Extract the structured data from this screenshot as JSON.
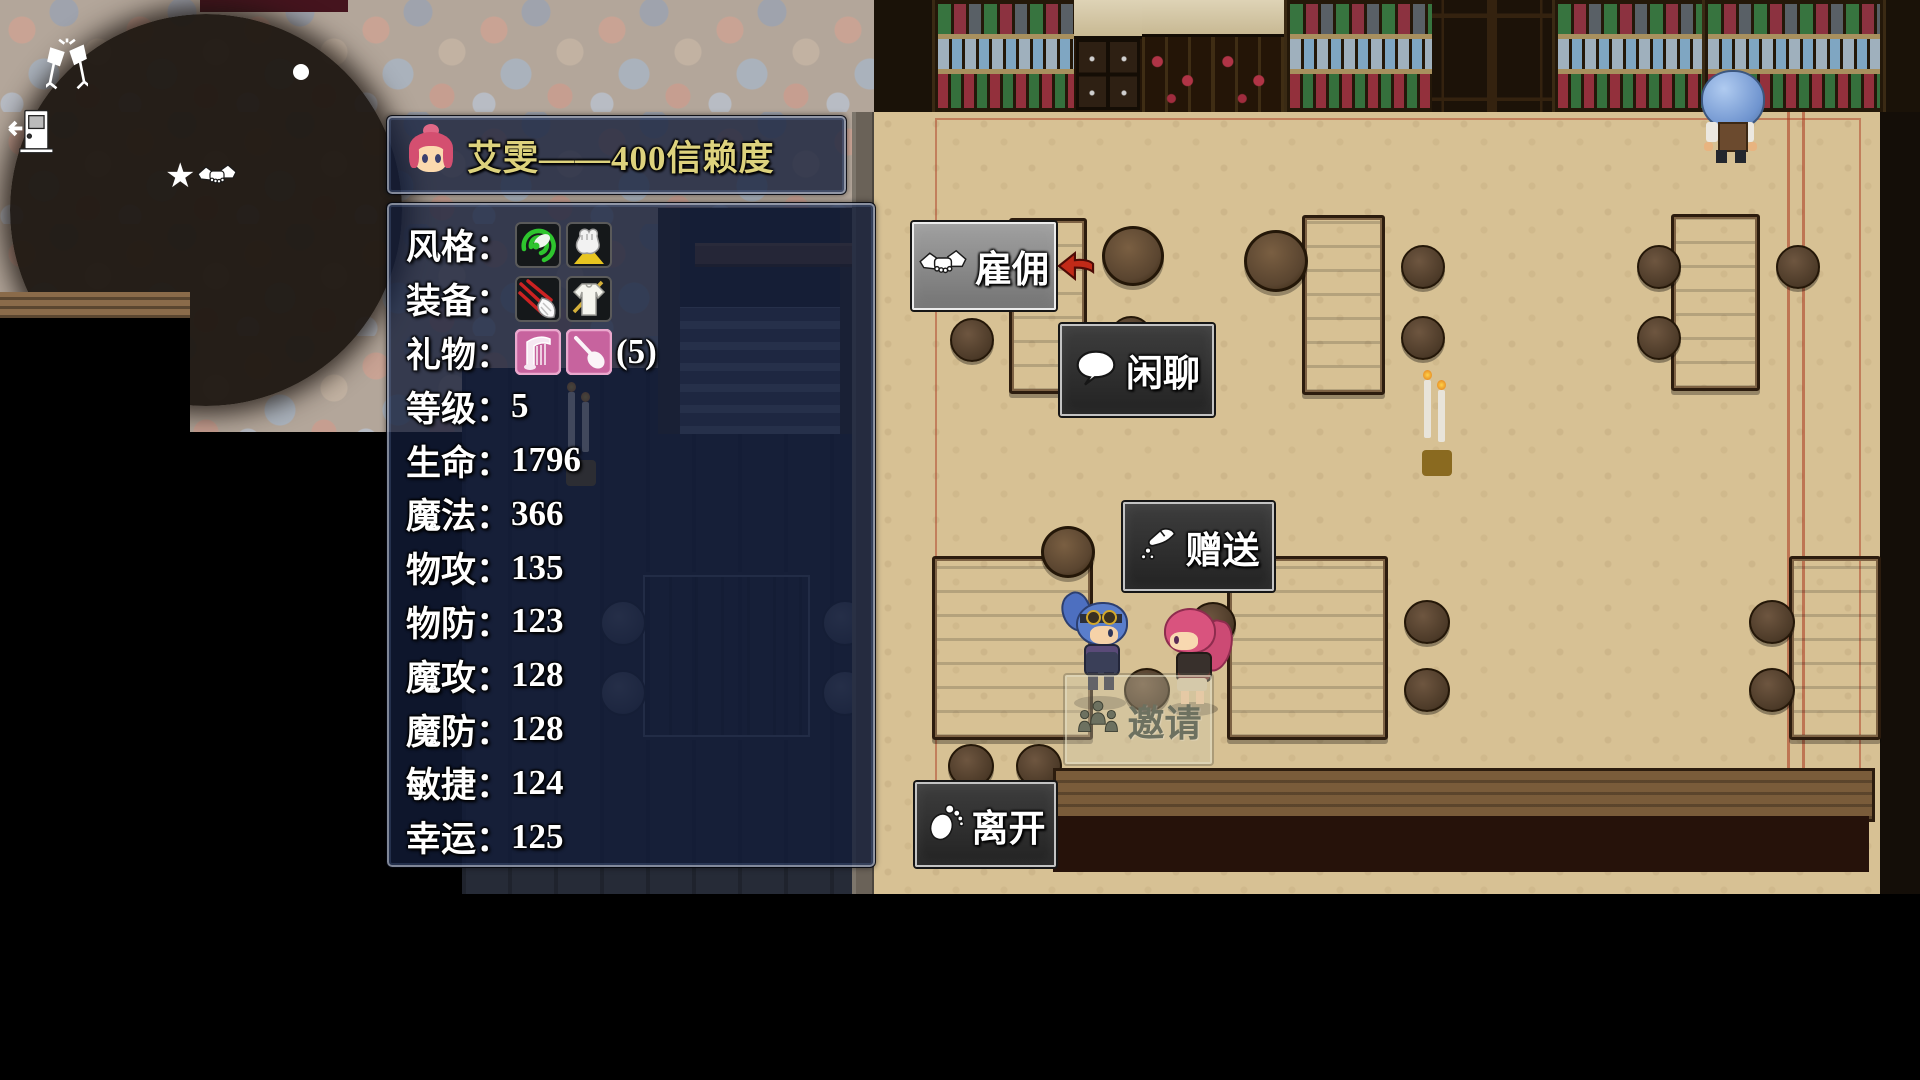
{
  "panel": {
    "title": "艾雯——400信赖度",
    "rows": [
      {
        "label": "风格：",
        "icons": [
          "style-green-whirl-icon",
          "style-yellow-fist-icon"
        ]
      },
      {
        "label": "装备：",
        "icons": [
          "equip-claw-icon",
          "equip-armor-icon"
        ]
      },
      {
        "label": "礼物：",
        "icons": [
          "gift-harp-icon",
          "gift-spoon-icon"
        ],
        "suffix": "(5)"
      },
      {
        "label": "等级：",
        "value": "5"
      },
      {
        "label": "生命：",
        "value": "1796"
      },
      {
        "label": "魔法：",
        "value": "366"
      },
      {
        "label": "物攻：",
        "value": "135"
      },
      {
        "label": "物防：",
        "value": "123"
      },
      {
        "label": "魔攻：",
        "value": "128"
      },
      {
        "label": "魔防：",
        "value": "128"
      },
      {
        "label": "敏捷：",
        "value": "124"
      },
      {
        "label": "幸运：",
        "value": "125"
      }
    ]
  },
  "action_menu": {
    "buttons": [
      {
        "label": "雇佣",
        "icon": "handshake-icon",
        "state": "selected"
      },
      {
        "label": "闲聊",
        "icon": "speech-bubble-icon",
        "state": "normal"
      },
      {
        "label": "赠送",
        "icon": "give-hand-icon",
        "state": "normal"
      },
      {
        "label": "邀请",
        "icon": "group-people-icon",
        "state": "disabled"
      },
      {
        "label": "离开",
        "icon": "footprint-icon",
        "state": "normal"
      }
    ],
    "cursor_icon": "red-arrow-left-cursor"
  },
  "minimap": {
    "icons": [
      "cheers-icon",
      "exit-door-icon",
      "meet-handshake-star-icon",
      "location-dot"
    ]
  },
  "colors": {
    "panel_bg": "rgba(18,28,56,0.78)",
    "title_text": "#ddd27d",
    "stat_text": "#ffffff",
    "button_bg": "#2e2e2e",
    "selected_button_bg": "#8b8b8b",
    "cursor_red": "#c12a18",
    "gift_icon_bg": "#c7639e",
    "floor_tan": "#d7c194"
  }
}
